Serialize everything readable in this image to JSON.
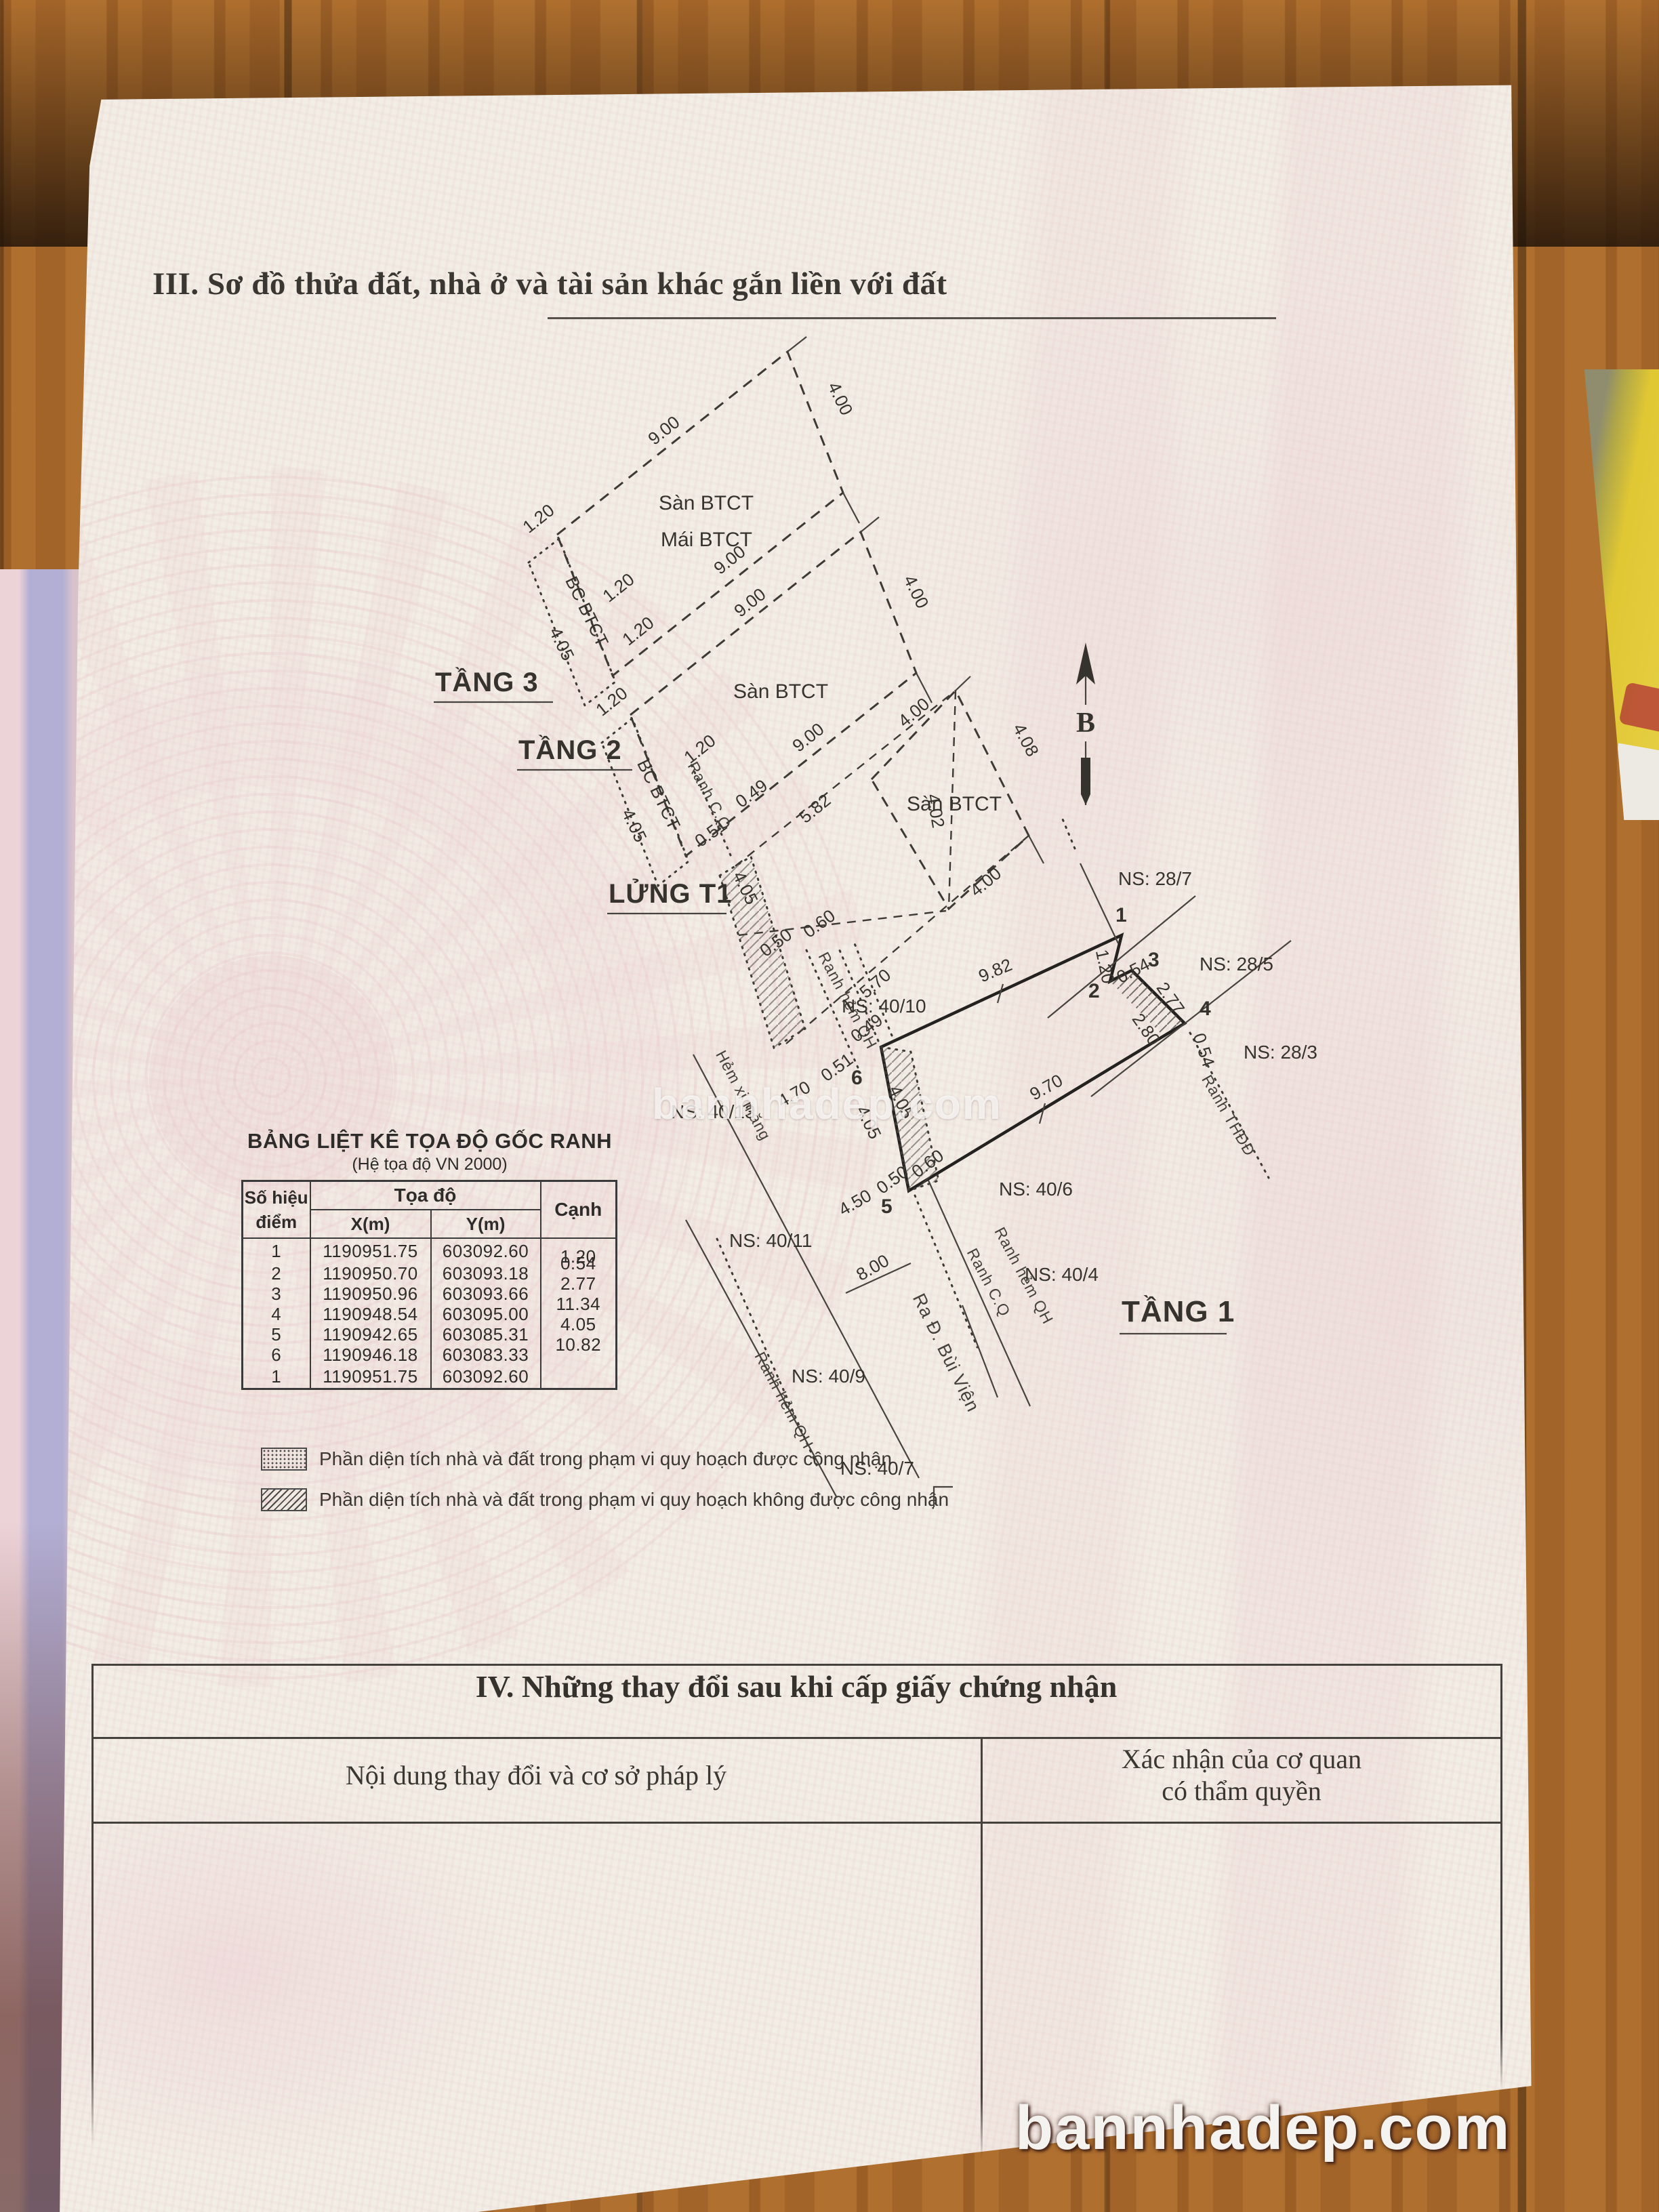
{
  "section3": {
    "title": "III. Sơ đồ thửa đất, nhà ở và tài sản khác gắn liền với đất"
  },
  "coord_table": {
    "title": "BẢNG LIỆT KÊ TỌA ĐỘ GỐC RANH",
    "subtitle": "(Hệ tọa độ VN 2000)",
    "h_point1": "Số hiệu",
    "h_point2": "điểm",
    "h_coord": "Tọa độ",
    "h_x": "X(m)",
    "h_y": "Y(m)",
    "h_edge": "Cạnh",
    "rows": [
      {
        "p": "1",
        "x": "1190951.75",
        "y": "603092.60",
        "c": "1.20"
      },
      {
        "p": "2",
        "x": "1190950.70",
        "y": "603093.18",
        "c": "0.54"
      },
      {
        "p": "3",
        "x": "1190950.96",
        "y": "603093.66",
        "c": "2.77"
      },
      {
        "p": "4",
        "x": "1190948.54",
        "y": "603095.00",
        "c": "11.34"
      },
      {
        "p": "5",
        "x": "1190942.65",
        "y": "603085.31",
        "c": "4.05"
      },
      {
        "p": "6",
        "x": "1190946.18",
        "y": "603083.33",
        "c": "10.82"
      },
      {
        "p": "1",
        "x": "1190951.75",
        "y": "603092.60",
        "c": ""
      }
    ]
  },
  "legend": {
    "item1": "Phần diện tích nhà và đất trong phạm vi quy hoạch được công nhận",
    "item2": "Phần diện tích nhà và đất trong phạm vi quy hoạch không được công nhận"
  },
  "section4": {
    "title": "IV. Những thay đổi sau khi cấp giấy chứng nhận",
    "col1": "Nội dung thay đổi và cơ sở pháp lý",
    "col2a": "Xác nhận của cơ quan",
    "col2b": "có thẩm quyền"
  },
  "watermark": {
    "center": "bannhadep.com",
    "bottom": "bannhadep.com"
  },
  "diagram": {
    "floors": {
      "t3": "TẦNG 3",
      "t2": "TẦNG 2",
      "lt1": "LỬNG T1",
      "t1": "TẦNG 1"
    },
    "labels": {
      "san": "Sàn BTCT",
      "mai": "Mái BTCT",
      "bc": "BC BTCT",
      "hem": "Hẻm xi măng",
      "bui_vien": "Ra Đ. Bùi Viện",
      "ranh_hem": "Ranh hẻm QH",
      "ranh_cq": "Ranh C.Q",
      "ranh_thdd": "Ranh THĐĐ",
      "north": "B"
    },
    "ns": {
      "a": "NS: 28/7",
      "b": "NS: 28/5",
      "c": "NS: 28/3",
      "d": "NS: 40/10",
      "e": "NS: 40/13",
      "f": "NS: 40/11",
      "g": "NS: 40/9",
      "h": "NS: 40/7",
      "i": "NS: 40/6",
      "j": "NS: 40/4"
    },
    "dims": {
      "d900": "9.00",
      "d400": "4.00",
      "d405": "4.05",
      "d408": "4.08",
      "d402": "4.02",
      "d120": "1.20",
      "d049": "0.49",
      "d051": "0.51",
      "d050": "0.50",
      "d060": "0.60",
      "d054": "0.54",
      "d277": "2.77",
      "d280": "2.80",
      "d582": "5.82",
      "d570": "5.70",
      "d982": "9.82",
      "d970": "9.70",
      "d470": "4.70",
      "d450": "4.50",
      "d800": "8.00"
    },
    "points": {
      "p1": "1",
      "p2": "2",
      "p3": "3",
      "p4": "4",
      "p5": "5",
      "p6": "6"
    }
  }
}
